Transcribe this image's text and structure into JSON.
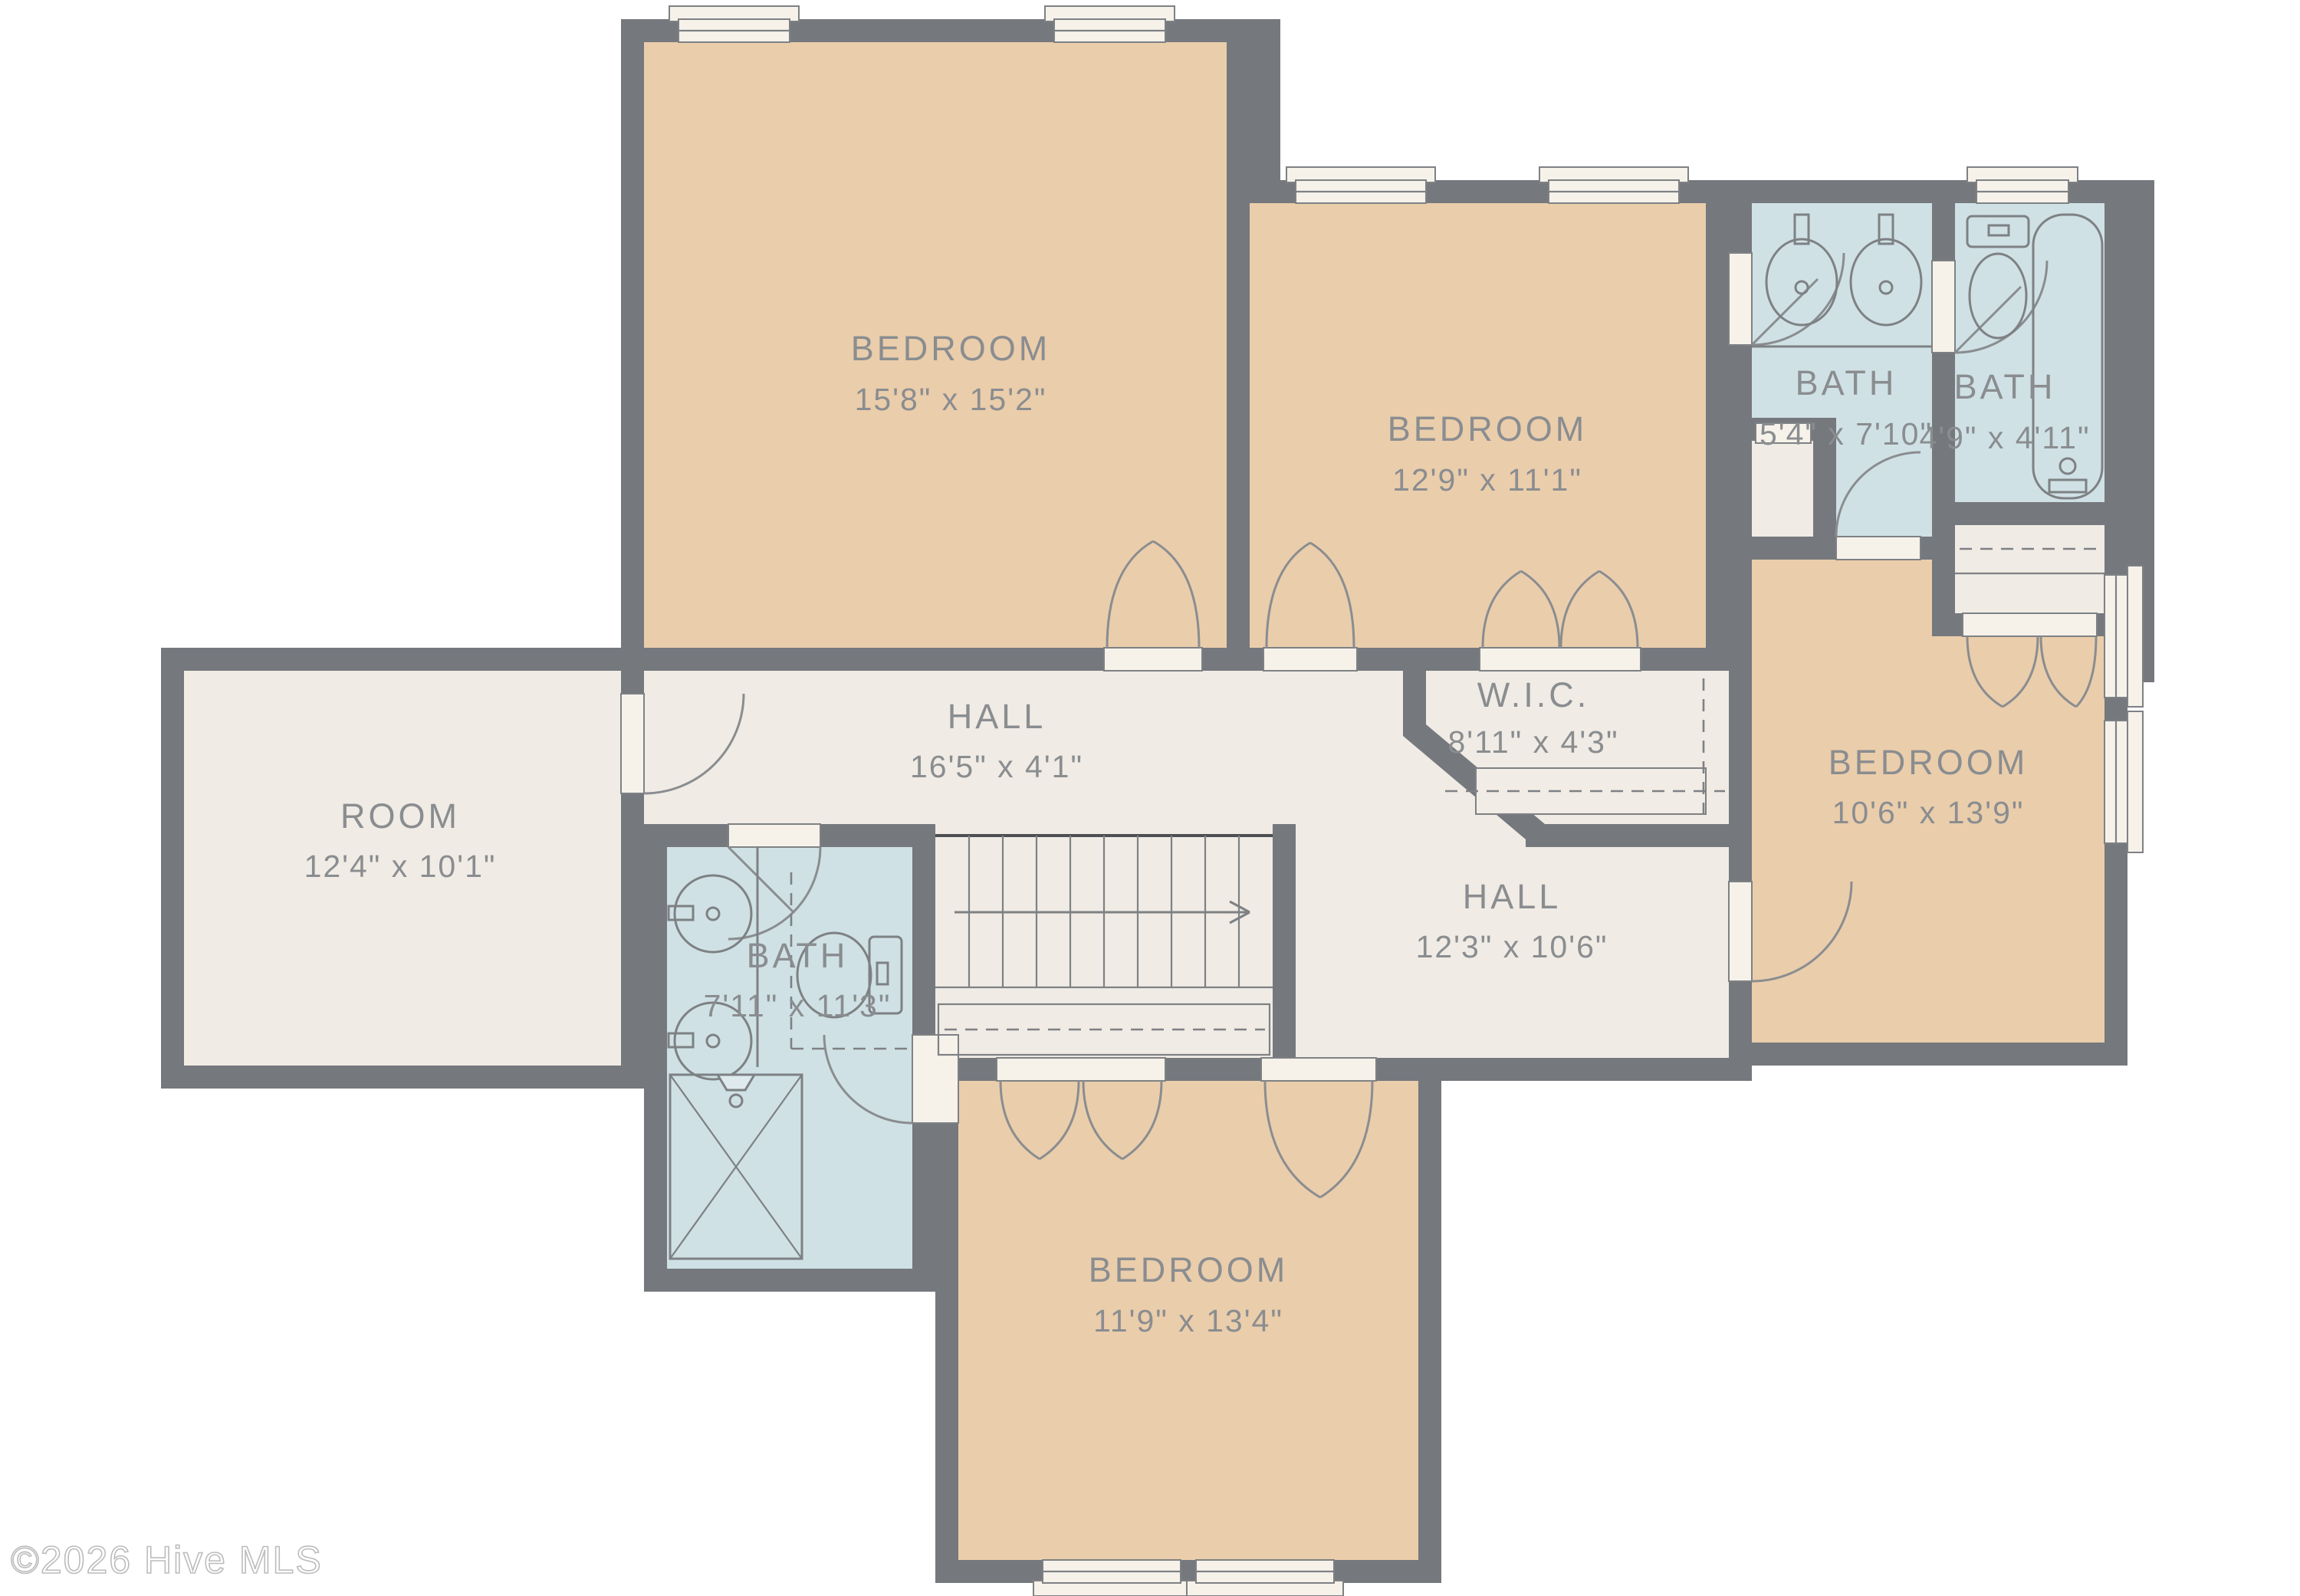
{
  "floor_plan": {
    "type": "residential-floor-plan",
    "watermark": "©2026 Hive MLS",
    "colors": {
      "wall": "#75787d",
      "bedroom_fill": "#eacdab",
      "bath_fill": "#cfe1e5",
      "hall_fill": "#f0ebe4",
      "window_fill": "#f6f2ea",
      "fixture_line": "#7e8184",
      "label_text": "#8a8d90",
      "background": "#ffffff"
    },
    "rooms": [
      {
        "id": "bedroom-top-left",
        "name": "BEDROOM",
        "dims": "15'8\" x 15'2\""
      },
      {
        "id": "bedroom-top-mid",
        "name": "BEDROOM",
        "dims": "12'9\" x 11'1\""
      },
      {
        "id": "bath-vanity",
        "name": "BATH",
        "dims": "5'4\" x 7'10\""
      },
      {
        "id": "bath-tub",
        "name": "BATH",
        "dims": "4'9\" x 4'11\""
      },
      {
        "id": "hall-upper",
        "name": "HALL",
        "dims": "16'5\" x 4'1\""
      },
      {
        "id": "walk-in-closet",
        "name": "W.I.C.",
        "dims": "8'11\" x 4'3\""
      },
      {
        "id": "room-left",
        "name": "ROOM",
        "dims": "12'4\" x 10'1\""
      },
      {
        "id": "bath-main",
        "name": "BATH",
        "dims": "7'11\" x 11'3\""
      },
      {
        "id": "hall-lower",
        "name": "HALL",
        "dims": "12'3\" x 10'6\""
      },
      {
        "id": "bedroom-right",
        "name": "BEDROOM",
        "dims": "10'6\" x 13'9\""
      },
      {
        "id": "bedroom-bottom",
        "name": "BEDROOM",
        "dims": "11'9\" x 13'4\""
      }
    ]
  }
}
